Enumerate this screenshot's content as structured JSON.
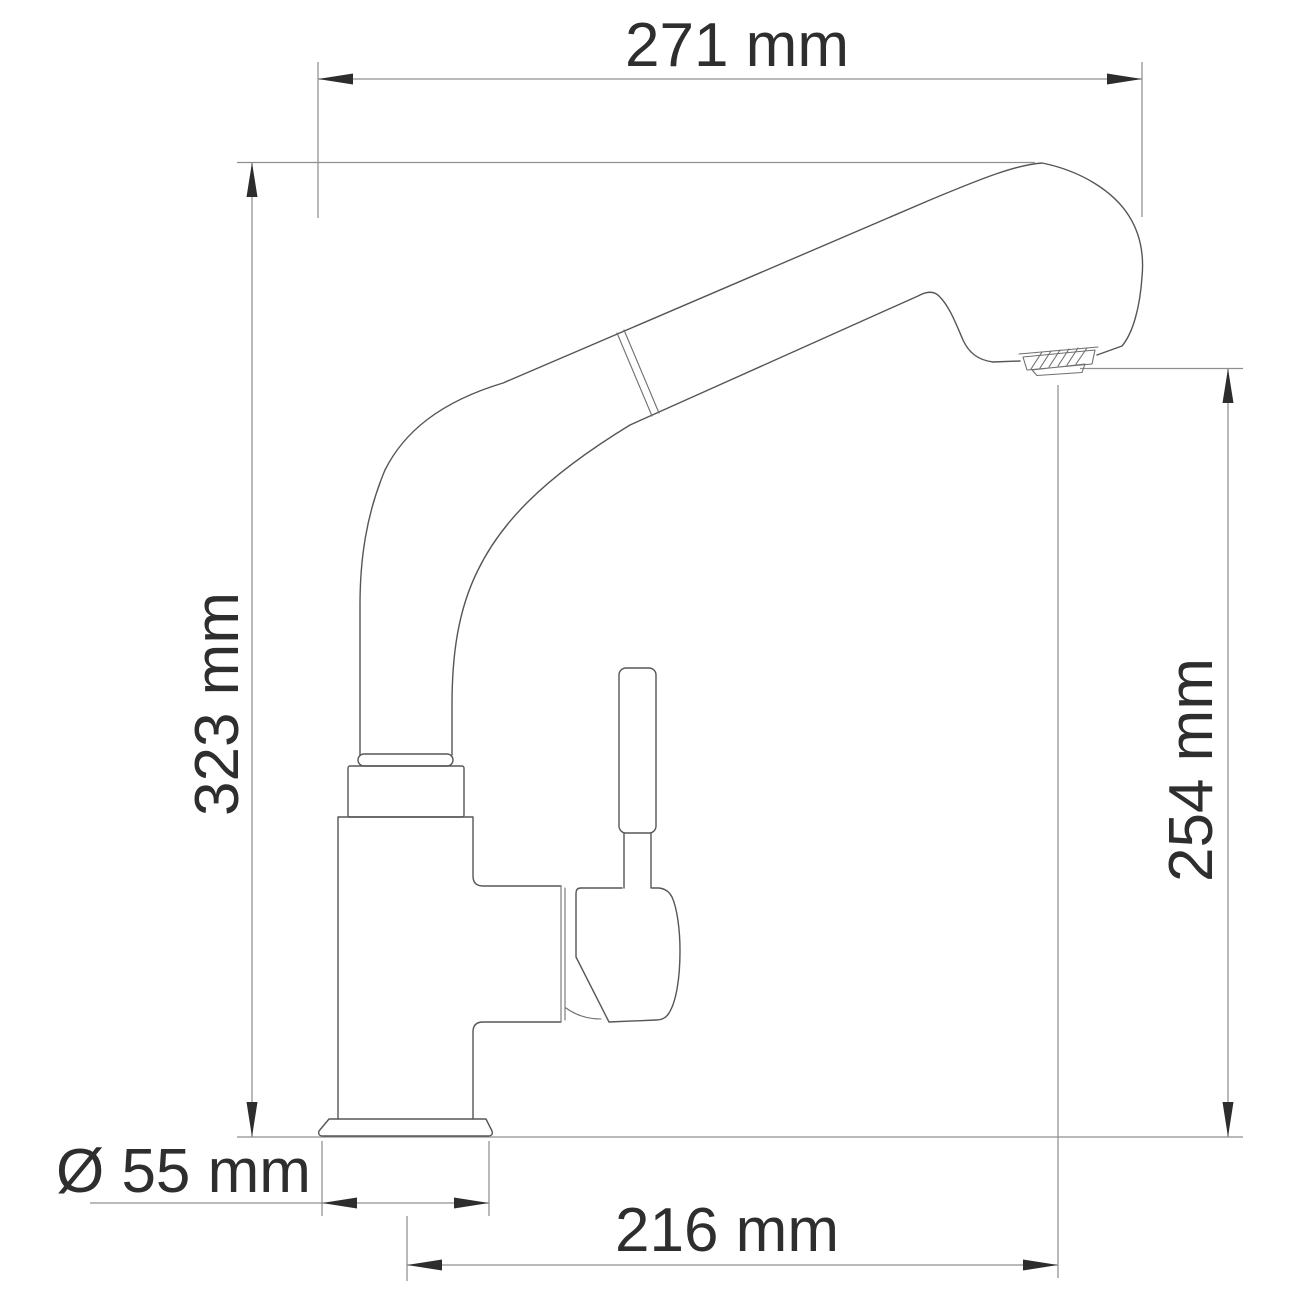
{
  "drawing_kind": "kitchen-faucet-dimension-drawing",
  "dims": {
    "top_width": "271 mm",
    "left_height": "323 mm",
    "right_height": "254 mm",
    "base_diameter": "Ø 55 mm",
    "bottom_depth": "216 mm"
  },
  "colors": {
    "background": "#ffffff",
    "outline": "#565656",
    "dimension_line": "#8f8f8f",
    "arrow": "#2d2d2d",
    "text": "#2e2e2e"
  }
}
